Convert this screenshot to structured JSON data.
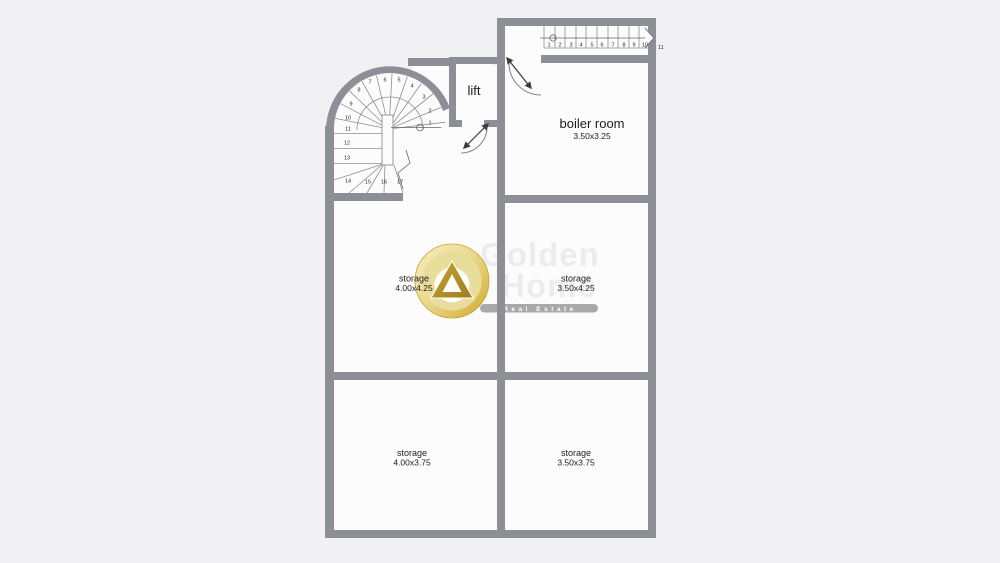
{
  "plan": {
    "background_color": "#f1f1f3",
    "wall_color": "#8c8f96",
    "floor_color": "#fcfcfd",
    "rooms": [
      {
        "id": "lift",
        "name": "lift"
      },
      {
        "id": "boiler-room",
        "name": "boiler room",
        "dims": "3.50x3.25"
      },
      {
        "id": "storage-mid-left",
        "name": "storage",
        "dims": "4.00x4.25"
      },
      {
        "id": "storage-mid-right",
        "name": "storage",
        "dims": "3.50x4.25"
      },
      {
        "id": "storage-bottom-left",
        "name": "storage",
        "dims": "4.00x3.75"
      },
      {
        "id": "storage-bottom-right",
        "name": "storage",
        "dims": "3.50x3.75"
      }
    ],
    "straight_stair_steps": [
      "1",
      "2",
      "3",
      "4",
      "5",
      "6",
      "7",
      "8",
      "9",
      "10",
      "11"
    ],
    "spiral_stair_steps": [
      "1",
      "2",
      "3",
      "4",
      "5",
      "6",
      "7",
      "8",
      "9",
      "10",
      "11",
      "12",
      "13",
      "14",
      "15",
      "16",
      "17"
    ]
  },
  "watermark": {
    "brand_line1": "Golden",
    "brand_line2": "Home",
    "tagline": "Real Estate",
    "gold_color": "#d8b23a",
    "badge_color": "#a9a9a9"
  }
}
